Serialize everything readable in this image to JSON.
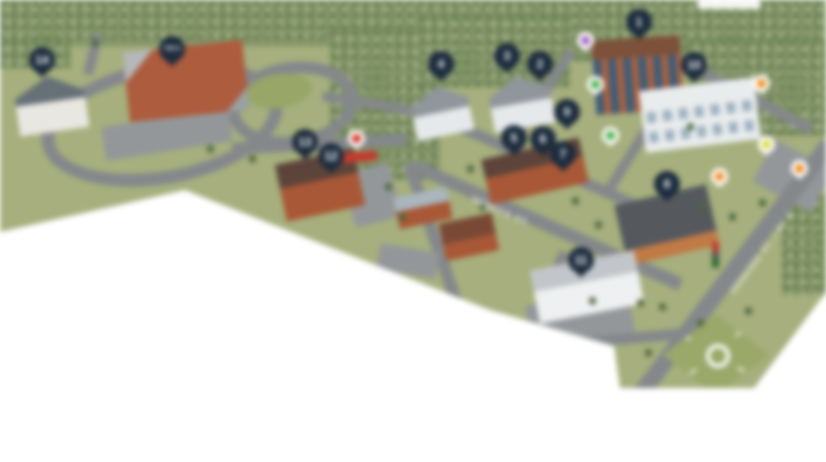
{
  "map": {
    "description": "Blurred isometric campus map with numbered location pins",
    "road_labels": [
      {
        "id": "seneca",
        "text": "SENECA ST."
      },
      {
        "id": "genesee",
        "text": "GENESEE ST. / RT 5"
      }
    ],
    "numbered_pins": [
      {
        "label": "1",
        "x": 639,
        "y": 22
      },
      {
        "label": "2",
        "x": 540,
        "y": 64
      },
      {
        "label": "3",
        "x": 507,
        "y": 56
      },
      {
        "label": "4",
        "x": 441,
        "y": 64
      },
      {
        "label": "5",
        "x": 514,
        "y": 138
      },
      {
        "label": "6",
        "x": 543,
        "y": 139
      },
      {
        "label": "7",
        "x": 563,
        "y": 154
      },
      {
        "label": "8",
        "x": 667,
        "y": 184
      },
      {
        "label": "9",
        "x": 567,
        "y": 112
      },
      {
        "label": "10",
        "x": 694,
        "y": 65
      },
      {
        "label": "11",
        "x": 581,
        "y": 260
      },
      {
        "label": "12",
        "x": 331,
        "y": 156
      },
      {
        "label": "13",
        "x": 305,
        "y": 142
      },
      {
        "label": "14",
        "x": 42,
        "y": 60
      },
      {
        "label": "YMCA",
        "x": 172,
        "y": 49
      }
    ],
    "poi_pins": [
      {
        "name": "purple-pin",
        "color": "#a15fc4",
        "x": 585,
        "y": 40
      },
      {
        "name": "green-pin",
        "color": "#46b04a",
        "x": 595,
        "y": 84
      },
      {
        "name": "green-pin",
        "color": "#46b04a",
        "x": 610,
        "y": 135
      },
      {
        "name": "orange-pin",
        "color": "#f08a1d",
        "x": 761,
        "y": 83
      },
      {
        "name": "yellow-pin",
        "color": "#ddd93e",
        "x": 766,
        "y": 144
      },
      {
        "name": "orange-pin",
        "color": "#f08a1d",
        "x": 719,
        "y": 176
      },
      {
        "name": "orange-pin",
        "color": "#f08a1d",
        "x": 799,
        "y": 168
      },
      {
        "name": "red-pin",
        "color": "#d93025",
        "x": 356,
        "y": 138
      }
    ],
    "colors": {
      "pin_navy": "#1d2c3e",
      "grass": "#a6af7d",
      "forest": "#87976b",
      "road": "#85888b",
      "brick": "#a85836",
      "page_background": "#ffffff"
    }
  }
}
